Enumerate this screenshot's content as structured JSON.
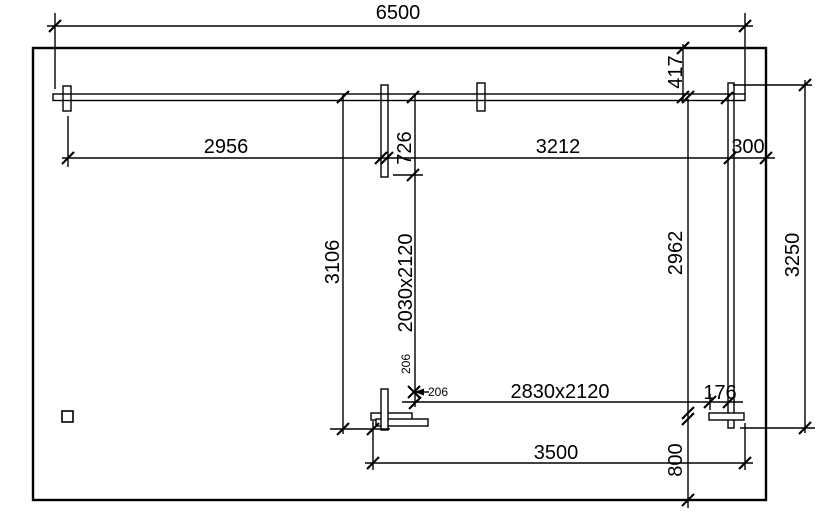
{
  "drawing": {
    "description": "dimensioned floor plan",
    "background_color": "#ffffff",
    "line_color": "#000000",
    "labels": {
      "overall_width": "6500",
      "front_span_left": "2956",
      "front_span_mid": "3212",
      "front_span_right": "300",
      "right_top_offset": "417",
      "mid_wall_offset": "726",
      "left_depth": "3106",
      "side_door_size": "2030x2120",
      "right_depth": "2962",
      "right_total_depth": "3250",
      "detail_offset_vertical": "206",
      "detail_offset_horizontal": "206",
      "rear_door_size": "2830x2120",
      "rear_gap": "176",
      "rear_span": "3500",
      "rear_right_offset": "800"
    }
  }
}
